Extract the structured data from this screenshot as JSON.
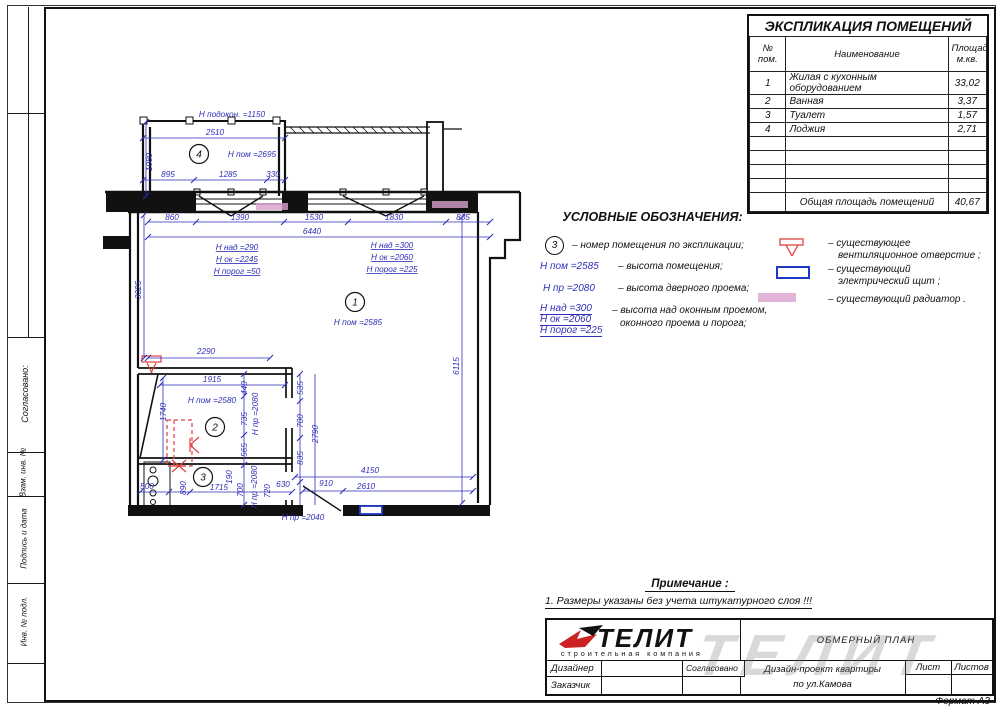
{
  "colors": {
    "dim_blue": "#2f2fb8",
    "red": "#e04040",
    "radiator_pink": "#d9a0cc",
    "panel_blue": "#1d39c4",
    "line_black": "#111111"
  },
  "sheet": {
    "format_label": "Формат А3"
  },
  "left_margin": {
    "agreed": "Согласовано:",
    "vzam": "Взам. инв. №",
    "podpis": "Подпись и дата",
    "inv": "Инв. № подл."
  },
  "explication": {
    "title": "ЭКСПЛИКАЦИЯ ПОМЕЩЕНИЙ",
    "header": {
      "num_line1": "№",
      "num_line2": "пом.",
      "name": "Наименование",
      "area_line1": "Площадь",
      "area_line2": "м.кв."
    },
    "rows": [
      {
        "num": "1",
        "name": "Жилая с кухонным оборудованием",
        "area": "33,02"
      },
      {
        "num": "2",
        "name": "Ванная",
        "area": "3,37"
      },
      {
        "num": "3",
        "name": "Туалет",
        "area": "1,57"
      },
      {
        "num": "4",
        "name": "Лоджия",
        "area": "2,71"
      }
    ],
    "empty_row_count": 4,
    "total": {
      "label": "Общая площадь помещений",
      "value": "40,67"
    }
  },
  "legend": {
    "title": "УСЛОВНЫЕ ОБОЗНАЧЕНИЯ:",
    "left": [
      {
        "circle": "3",
        "text": "– номер помещения по экспликации;"
      },
      {
        "term": "H пом =2585",
        "text": "– высота помещения;"
      },
      {
        "term": "H пр =2080",
        "text": "– высота дверного проема;"
      },
      {
        "terms": [
          "H над =300",
          "H ок =2060",
          "H порог =225"
        ],
        "text_line1": "– высота над оконным проемом,",
        "text_line2": "оконного проема и порога;"
      }
    ],
    "right": [
      {
        "symbol": "vent",
        "line1": "– существующее",
        "line2": "вентиляционное отверстие ;"
      },
      {
        "symbol": "electric-panel",
        "line1": "– существующий",
        "line2": "электрический щит ;"
      },
      {
        "symbol": "radiator",
        "line1": "– существующий радиатор .",
        "line2": ""
      }
    ]
  },
  "note": {
    "title": "Примечание :",
    "item": "1.  Размеры указаны без учета штукатурного слоя !!!"
  },
  "title_block": {
    "logo_text": "ТЕЛИТ",
    "logo_subtitle": "строительная компания",
    "doc_title": "ОБМЕРНЫЙ ПЛАН",
    "project_line1": "Дизайн-проект квартиры",
    "project_line2": "по ул.Камова",
    "role_designer": "Дизайнер",
    "role_customer": "Заказчик",
    "approved_label": "Согласовано",
    "sheet_label": "Лист",
    "sheets_label": "Листов",
    "watermark": "ТЕЛИТ"
  },
  "plan": {
    "labels": [
      {
        "t": "H подокон. =1150",
        "x": 232,
        "y": 117
      },
      {
        "t": "2510",
        "x": 215,
        "y": 135
      },
      {
        "t": "4",
        "x": 199,
        "y": 154,
        "circle": true
      },
      {
        "t": "H пом =2695",
        "x": 252,
        "y": 157
      },
      {
        "t": "1080",
        "x": 152,
        "y": 162,
        "r": -90
      },
      {
        "t": "895",
        "x": 168,
        "y": 177
      },
      {
        "t": "1285",
        "x": 228,
        "y": 177
      },
      {
        "t": "330",
        "x": 273,
        "y": 177
      },
      {
        "t": "860",
        "x": 172,
        "y": 220
      },
      {
        "t": "1390",
        "x": 240,
        "y": 220
      },
      {
        "t": "1530",
        "x": 314,
        "y": 220
      },
      {
        "t": "1830",
        "x": 394,
        "y": 220
      },
      {
        "t": "835",
        "x": 463,
        "y": 220
      },
      {
        "t": "6440",
        "x": 312,
        "y": 234
      },
      {
        "t": "H над =290",
        "x": 237,
        "y": 250,
        "u": true
      },
      {
        "t": "H ок =2245",
        "x": 237,
        "y": 262,
        "u": true
      },
      {
        "t": "H порог =50",
        "x": 237,
        "y": 274,
        "u": true
      },
      {
        "t": "H над =300",
        "x": 392,
        "y": 248,
        "u": true
      },
      {
        "t": "H ок =2060",
        "x": 392,
        "y": 260,
        "u": true
      },
      {
        "t": "H порог =225",
        "x": 392,
        "y": 272,
        "u": true
      },
      {
        "t": "3325",
        "x": 141,
        "y": 290,
        "r": -90
      },
      {
        "t": "1",
        "x": 355,
        "y": 302,
        "circle": true
      },
      {
        "t": "H пом =2585",
        "x": 358,
        "y": 325
      },
      {
        "t": "6115",
        "x": 459,
        "y": 366,
        "r": -90
      },
      {
        "t": "2290",
        "x": 206,
        "y": 354
      },
      {
        "t": "1915",
        "x": 212,
        "y": 382
      },
      {
        "t": "440",
        "x": 247,
        "y": 388,
        "r": -90
      },
      {
        "t": "535",
        "x": 303,
        "y": 388,
        "r": -90
      },
      {
        "t": "H пом =2580",
        "x": 212,
        "y": 403
      },
      {
        "t": "1740",
        "x": 166,
        "y": 412,
        "r": -90
      },
      {
        "t": "735",
        "x": 247,
        "y": 419,
        "r": -90
      },
      {
        "t": "H пр =2080",
        "x": 258,
        "y": 414,
        "r": -90
      },
      {
        "t": "700",
        "x": 303,
        "y": 421,
        "r": -90
      },
      {
        "t": "2790",
        "x": 318,
        "y": 434,
        "r": -90
      },
      {
        "t": "2",
        "x": 215,
        "y": 427,
        "circle": true
      },
      {
        "t": "565",
        "x": 247,
        "y": 450,
        "r": -90
      },
      {
        "t": "835",
        "x": 303,
        "y": 458,
        "r": -90
      },
      {
        "t": "3",
        "x": 203,
        "y": 477,
        "circle": true
      },
      {
        "t": "500",
        "x": 147,
        "y": 489
      },
      {
        "t": "890",
        "x": 186,
        "y": 488,
        "r": -90
      },
      {
        "t": "1715",
        "x": 219,
        "y": 490
      },
      {
        "t": "190",
        "x": 232,
        "y": 477,
        "r": -90
      },
      {
        "t": "700",
        "x": 243,
        "y": 490,
        "r": -90
      },
      {
        "t": "H пр =2080",
        "x": 257,
        "y": 487,
        "r": -90
      },
      {
        "t": "720",
        "x": 270,
        "y": 491,
        "r": -90
      },
      {
        "t": "630",
        "x": 283,
        "y": 487
      },
      {
        "t": "910",
        "x": 326,
        "y": 486
      },
      {
        "t": "4150",
        "x": 370,
        "y": 473
      },
      {
        "t": "2610",
        "x": 366,
        "y": 489
      },
      {
        "t": "H пр =2040",
        "x": 303,
        "y": 520
      }
    ]
  }
}
